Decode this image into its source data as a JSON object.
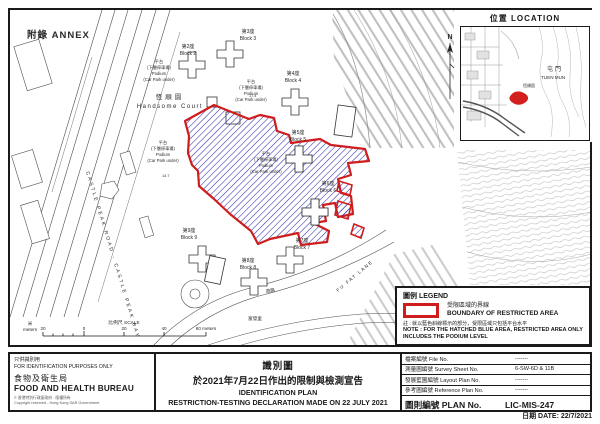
{
  "page": {
    "annex_label": "附錄 ANNEX",
    "date_line": "日期 DATE: 22/7/2021",
    "north_label": "N"
  },
  "inset": {
    "title": "位置 LOCATION",
    "district_zh": "屯門",
    "district_en": "TUEN MUN",
    "site_label": "恆順園"
  },
  "scale_bar": {
    "unit_zh": "米",
    "unit_en": "meters",
    "label": "比例尺 SCALE",
    "tick_left": "20",
    "tick_0": "0",
    "tick_20": "20",
    "tick_40": "40",
    "end_label": "60 meters"
  },
  "map": {
    "estate_zh": "恆順園",
    "estate_en": "Handsome Court",
    "blocks": [
      {
        "zh": "第2座",
        "en": "Block 2"
      },
      {
        "zh": "第3座",
        "en": "Block 3"
      },
      {
        "zh": "第4座",
        "en": "Block 4"
      },
      {
        "zh": "第5座",
        "en": "Block 5"
      },
      {
        "zh": "第6座",
        "en": "Block 6"
      },
      {
        "zh": "第7座",
        "en": "Block 7"
      },
      {
        "zh": "第8座",
        "en": "Block 8"
      },
      {
        "zh": "第9座",
        "en": "Block 9"
      }
    ],
    "podium": {
      "l1": "平台",
      "l2": "(下層停車場)",
      "l3": "Podium",
      "l4": "(Car Park under)"
    },
    "roads": {
      "castle_peak": "CASTLE PEAK ROAD - CASTLE PEAK BAY",
      "fu_fat_lane": "FU FAT LANE",
      "road_zh": "道路",
      "fu_fat_zh": "富發里"
    },
    "spot_heights": [
      "14.7",
      "17.4"
    ]
  },
  "legend": {
    "title": "圖例 LEGEND",
    "boundary_zh": "受限區域的界線",
    "boundary_en": "BOUNDARY OF RESTRICTED AREA",
    "note_zh": "註 : 就以藍色斜線標示的部分，受限區域只包括平台水平",
    "note_en_1": "NOTE : FOR THE HATCHED BLUE AREA, RESTRICTED AREA ONLY",
    "note_en_2": "INCLUDES THE PODIUM LEVEL"
  },
  "footer": {
    "left": {
      "id_zh": "只供識別用",
      "id_en": "FOR IDENTIFICATION PURPOSES ONLY",
      "bureau_zh": "食物及衛生局",
      "bureau_en": "FOOD AND HEALTH BUREAU",
      "copyright_zh": "© 香港特別行政區政府 - 版權所有",
      "copyright_en": "Copyright reserved - Hong Kong SAR Government"
    },
    "center": {
      "title_zh": "識別圖",
      "subtitle_zh": "於2021年7月22日作出的限制與檢測宣告",
      "title_en": "IDENTIFICATION PLAN",
      "subtitle_en": "RESTRICTION-TESTING DECLARATION MADE ON 22 JULY 2021"
    },
    "table": {
      "rows": [
        {
          "zh": "檔案編號",
          "en": "File No.",
          "value": "-------"
        },
        {
          "zh": "測量圖編號",
          "en": "Survey Sheet No.",
          "value": "6-SW-6D & 11B"
        },
        {
          "zh": "發展藍圖編號",
          "en": "Layout Plan No.",
          "value": "-------"
        },
        {
          "zh": "參考圖編號",
          "en": "Reference Plan No.",
          "value": "-------"
        }
      ],
      "plan_zh": "圖則編號",
      "plan_en": "PLAN No.",
      "plan_value": "LIC-MIS-247"
    }
  },
  "colors": {
    "boundary_red": "#cf1d1d",
    "hatch_blue": "#2b2fae"
  }
}
